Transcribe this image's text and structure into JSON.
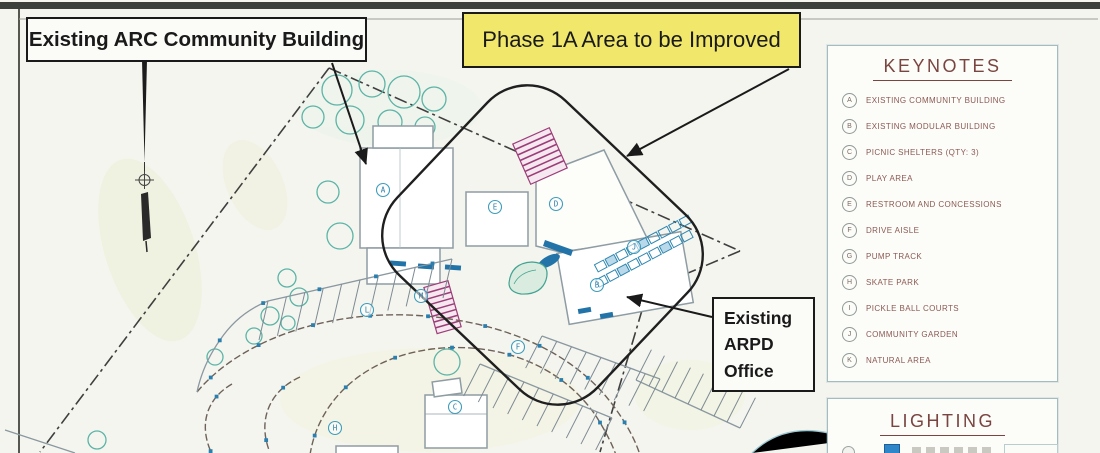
{
  "callouts": {
    "arc_building": "Existing ARC Community Building",
    "phase_1a": "Phase 1A Area to be Improved",
    "arpd_office_lines": [
      "Existing",
      "ARPD",
      "Office"
    ]
  },
  "keynotes": {
    "title": "KEYNOTES",
    "items": [
      {
        "key": "A",
        "label": "EXISTING COMMUNITY BUILDING"
      },
      {
        "key": "B",
        "label": "EXISTING MODULAR BUILDING"
      },
      {
        "key": "C",
        "label": "PICNIC SHELTERS (QTY: 3)"
      },
      {
        "key": "D",
        "label": "PLAY AREA"
      },
      {
        "key": "E",
        "label": "RESTROOM AND CONCESSIONS"
      },
      {
        "key": "F",
        "label": "DRIVE AISLE"
      },
      {
        "key": "G",
        "label": "PUMP TRACK"
      },
      {
        "key": "H",
        "label": "SKATE PARK"
      },
      {
        "key": "I",
        "label": "PICKLE BALL COURTS"
      },
      {
        "key": "J",
        "label": "COMMUNITY GARDEN"
      },
      {
        "key": "K",
        "label": "NATURAL AREA"
      }
    ]
  },
  "lighting": {
    "title": "LIGHTING"
  },
  "plan": {
    "markers": [
      {
        "letter": "A",
        "x": 383,
        "y": 190
      },
      {
        "letter": "E",
        "x": 495,
        "y": 207
      },
      {
        "letter": "D",
        "x": 556,
        "y": 204
      },
      {
        "letter": "B",
        "x": 597,
        "y": 285
      },
      {
        "letter": "J",
        "x": 634,
        "y": 247
      },
      {
        "letter": "M",
        "x": 421,
        "y": 296
      },
      {
        "letter": "L",
        "x": 367,
        "y": 310
      },
      {
        "letter": "F",
        "x": 518,
        "y": 347
      },
      {
        "letter": "C",
        "x": 455,
        "y": 407
      },
      {
        "letter": "H",
        "x": 335,
        "y": 428
      }
    ]
  },
  "colors": {
    "highlight_yellow": "#f0e76b",
    "callout_border": "#1a1a1a",
    "keynote_heading": "#7a4540",
    "keynote_text": "#8c5a52",
    "plan_teal": "#4aa3b8",
    "plan_blue": "#2173a8",
    "plan_magenta": "#9c3d78"
  }
}
